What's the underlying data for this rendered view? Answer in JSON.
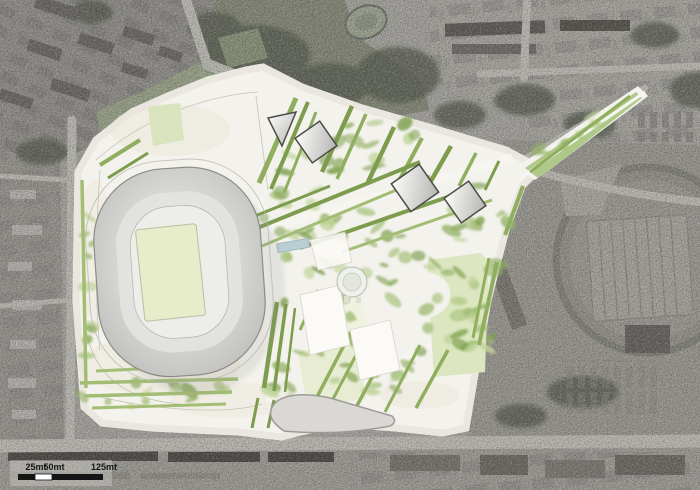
{
  "document": {
    "type": "architectural masterplan site plan over grayscale aerial orthophoto",
    "features": [
      "stadium bowl with playing pitch",
      "central park with rows of trees",
      "glass pavilion squares",
      "central dome pavilion",
      "water feature",
      "hippodrome oval track",
      "scale bar"
    ]
  },
  "scale_bar": {
    "unit": "mt",
    "ticks": [
      "25mt",
      "50mt",
      "125mt"
    ]
  },
  "colors": {
    "aerial_base": "#a2a09b",
    "aerial_dark_block": "#4f4d48",
    "road": "#b8b6b0",
    "plan_paper": "#f3f2ed",
    "plan_edge": "#a19f98",
    "stadium_rim": "#8b8b87",
    "pitch": "#e7edca",
    "pitch_edge": "#b9bfa0",
    "lawn": "#dce6c0",
    "lawn_top": "#d9e3bd",
    "lawn_south": "#e4ebcd",
    "tree_row_a": "#8fae5e",
    "tree_row_b": "#7d9c4e",
    "tree_row_c": "#a3bd74",
    "blob_palette": [
      "#a9c47f",
      "#93b264",
      "#bfd49a",
      "#7fa050"
    ],
    "water": "#b9ced3",
    "glass_edge": "#4a4a46",
    "ink": "#151515"
  }
}
